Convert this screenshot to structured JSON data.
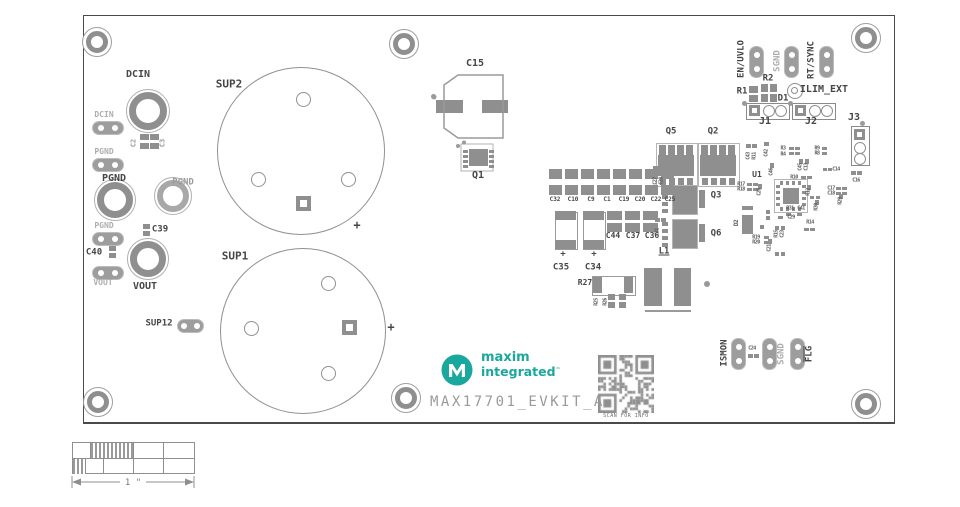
{
  "board": {
    "title": "MAX17701_EVKIT_A",
    "qr_caption": "SCAN FOR INFO",
    "scale_label": "1 \"",
    "brand": {
      "line1": "maxim",
      "line2": "integrated",
      "tm": "™"
    }
  },
  "colors": {
    "teal": "#1aa79e",
    "silk_gray": "#8f8f8f",
    "label_dark": "#464646",
    "label_light": "#aeaeae"
  },
  "labels": [
    {
      "id": "dcin-terminal",
      "text": "DCIN",
      "x": 138,
      "y": 75
    },
    {
      "id": "pgnd-terminal",
      "text": "PGND",
      "x": 114,
      "y": 179
    },
    {
      "id": "pgnd-terminal-2",
      "text": "PGND",
      "x": 183,
      "y": 183,
      "cls": "med",
      "size": 9
    },
    {
      "id": "vout-terminal",
      "text": "VOUT",
      "x": 145,
      "y": 287
    },
    {
      "id": "sup2",
      "text": "SUP2",
      "x": 229,
      "y": 84,
      "size": 11
    },
    {
      "id": "sup1",
      "text": "SUP1",
      "x": 235,
      "y": 256,
      "size": 11
    },
    {
      "id": "sup12",
      "text": "SUP12",
      "x": 159,
      "y": 324,
      "size": 9
    },
    {
      "id": "dcin-tp",
      "text": "DCIN",
      "x": 104,
      "y": 115,
      "cls": "light",
      "size": 8
    },
    {
      "id": "pgnd-tp1",
      "text": "PGND",
      "x": 104,
      "y": 152,
      "cls": "light",
      "size": 8
    },
    {
      "id": "pgnd-tp2",
      "text": "PGND",
      "x": 104,
      "y": 226,
      "cls": "light",
      "size": 8
    },
    {
      "id": "vout-tp",
      "text": "VOUT",
      "x": 103,
      "y": 283,
      "cls": "light",
      "size": 8
    },
    {
      "id": "c2",
      "text": "C2",
      "x": 134,
      "y": 143,
      "rot": -90,
      "cls": "med",
      "size": 7
    },
    {
      "id": "c3",
      "text": "C3",
      "x": 163,
      "y": 143,
      "rot": -90,
      "cls": "med",
      "size": 7
    },
    {
      "id": "c39",
      "text": "C39",
      "x": 160,
      "y": 230,
      "size": 9
    },
    {
      "id": "c40",
      "text": "C40",
      "x": 94,
      "y": 253,
      "size": 9
    },
    {
      "id": "c15",
      "text": "C15",
      "x": 475,
      "y": 64
    },
    {
      "id": "q1",
      "text": "Q1",
      "x": 478,
      "y": 176
    },
    {
      "id": "sup2-plus",
      "text": "+",
      "x": 357,
      "y": 225,
      "size": 12
    },
    {
      "id": "sup1-plus",
      "text": "+",
      "x": 391,
      "y": 327,
      "size": 12
    },
    {
      "id": "c32",
      "text": "C32",
      "x": 555,
      "y": 200,
      "size": 6
    },
    {
      "id": "c10",
      "text": "C10",
      "x": 573,
      "y": 200,
      "size": 6
    },
    {
      "id": "c9",
      "text": "C9",
      "x": 591,
      "y": 200,
      "size": 6
    },
    {
      "id": "c1",
      "text": "C1",
      "x": 607,
      "y": 200,
      "size": 6
    },
    {
      "id": "c19",
      "text": "C19",
      "x": 624,
      "y": 200,
      "size": 6
    },
    {
      "id": "c20",
      "text": "C20",
      "x": 640,
      "y": 200,
      "size": 6
    },
    {
      "id": "c22",
      "text": "C22",
      "x": 656,
      "y": 200,
      "size": 6
    },
    {
      "id": "c25",
      "text": "C25",
      "x": 670,
      "y": 200,
      "size": 6
    },
    {
      "id": "c44",
      "text": "C44",
      "x": 613,
      "y": 236,
      "size": 8
    },
    {
      "id": "c37",
      "text": "C37",
      "x": 633,
      "y": 236,
      "size": 8
    },
    {
      "id": "c36",
      "text": "C36",
      "x": 652,
      "y": 236,
      "size": 8
    },
    {
      "id": "c35",
      "text": "C35",
      "x": 561,
      "y": 268,
      "size": 9
    },
    {
      "id": "c34",
      "text": "C34",
      "x": 593,
      "y": 268,
      "size": 9
    },
    {
      "id": "c35-plus",
      "text": "+",
      "x": 563,
      "y": 255,
      "size": 9
    },
    {
      "id": "c34-plus",
      "text": "+",
      "x": 594,
      "y": 255,
      "size": 9
    },
    {
      "id": "r27",
      "text": "R27",
      "x": 585,
      "y": 283,
      "size": 8
    },
    {
      "id": "r25",
      "text": "R25",
      "x": 597,
      "y": 302,
      "rot": -90,
      "cls": "tiny"
    },
    {
      "id": "r26",
      "text": "R26",
      "x": 606,
      "y": 302,
      "rot": -90,
      "cls": "tiny"
    },
    {
      "id": "l1",
      "text": "L1",
      "x": 664,
      "y": 252,
      "size": 9,
      "cls": "underline"
    },
    {
      "id": "q5",
      "text": "Q5",
      "x": 671,
      "y": 132,
      "size": 9
    },
    {
      "id": "q2",
      "text": "Q2",
      "x": 713,
      "y": 132,
      "size": 9
    },
    {
      "id": "q3",
      "text": "Q3",
      "x": 716,
      "y": 196,
      "size": 9
    },
    {
      "id": "q6",
      "text": "Q6",
      "x": 716,
      "y": 234,
      "size": 9
    },
    {
      "id": "c27",
      "text": "C27",
      "x": 656,
      "y": 181,
      "rot": -90,
      "cls": "tiny"
    },
    {
      "id": "c28",
      "text": "C28",
      "x": 662,
      "y": 181,
      "rot": -90,
      "cls": "tiny"
    },
    {
      "id": "c31",
      "text": "C31",
      "x": 658,
      "y": 232,
      "rot": -90,
      "cls": "tiny"
    },
    {
      "id": "en-uvlo",
      "text": "EN/UVLO",
      "x": 742,
      "y": 59,
      "rot": -90,
      "size": 9
    },
    {
      "id": "sgnd-top",
      "text": "SGND",
      "x": 778,
      "y": 61,
      "rot": -90,
      "cls": "light",
      "size": 9
    },
    {
      "id": "rt-sync",
      "text": "RT/SYNC",
      "x": 812,
      "y": 60,
      "rot": -90,
      "size": 9
    },
    {
      "id": "r2",
      "text": "R2",
      "x": 768,
      "y": 79,
      "size": 9
    },
    {
      "id": "r1",
      "text": "R1",
      "x": 742,
      "y": 92,
      "size": 9
    },
    {
      "id": "d1",
      "text": "D1",
      "x": 783,
      "y": 99,
      "size": 9
    },
    {
      "id": "ilim-ext",
      "text": "ILIM_EXT",
      "x": 824,
      "y": 90
    },
    {
      "id": "j1",
      "text": "J1",
      "x": 765,
      "y": 122
    },
    {
      "id": "j2",
      "text": "J2",
      "x": 811,
      "y": 122
    },
    {
      "id": "j3",
      "text": "J3",
      "x": 854,
      "y": 118
    },
    {
      "id": "ismon",
      "text": "ISMON",
      "x": 725,
      "y": 353,
      "rot": -90,
      "size": 9
    },
    {
      "id": "c24",
      "text": "C24",
      "x": 752,
      "y": 349,
      "cls": "tiny"
    },
    {
      "id": "sgnd-bottom",
      "text": "SGND",
      "x": 782,
      "y": 354,
      "rot": -90,
      "cls": "light",
      "size": 9
    },
    {
      "id": "flg",
      "text": "FLG",
      "x": 810,
      "y": 354,
      "rot": -90,
      "size": 9,
      "cls": "overline"
    },
    {
      "id": "u1",
      "text": "U1",
      "x": 757,
      "y": 175,
      "size": 8
    },
    {
      "id": "c43",
      "text": "C43",
      "x": 749,
      "y": 156,
      "rot": -90,
      "cls": "tiny"
    },
    {
      "id": "r11",
      "text": "R11",
      "x": 755,
      "y": 156,
      "rot": -90,
      "cls": "tiny"
    },
    {
      "id": "c42",
      "text": "C42",
      "x": 767,
      "y": 153,
      "rot": -90,
      "cls": "tiny"
    },
    {
      "id": "r3",
      "text": "R3",
      "x": 783,
      "y": 149,
      "cls": "tiny"
    },
    {
      "id": "r4",
      "text": "R4",
      "x": 783,
      "y": 155,
      "cls": "tiny"
    },
    {
      "id": "r9",
      "text": "R9",
      "x": 817,
      "y": 149,
      "cls": "tiny"
    },
    {
      "id": "r8",
      "text": "R8",
      "x": 817,
      "y": 154,
      "cls": "tiny"
    },
    {
      "id": "c46",
      "text": "C46",
      "x": 772,
      "y": 172,
      "rot": -90,
      "cls": "tiny"
    },
    {
      "id": "c45",
      "text": "C45",
      "x": 801,
      "y": 167,
      "rot": -90,
      "cls": "tiny"
    },
    {
      "id": "c13",
      "text": "C13",
      "x": 807,
      "y": 167,
      "rot": -90,
      "cls": "tiny"
    },
    {
      "id": "c14",
      "text": "C14",
      "x": 836,
      "y": 170,
      "cls": "tiny"
    },
    {
      "id": "r10",
      "text": "R10",
      "x": 794,
      "y": 178,
      "cls": "tiny"
    },
    {
      "id": "r17",
      "text": "R17",
      "x": 741,
      "y": 185,
      "cls": "tiny"
    },
    {
      "id": "r18",
      "text": "R18",
      "x": 741,
      "y": 190,
      "cls": "tiny"
    },
    {
      "id": "c26",
      "text": "C26",
      "x": 760,
      "y": 192,
      "rot": -90,
      "cls": "tiny"
    },
    {
      "id": "d2",
      "text": "D2",
      "x": 737,
      "y": 223,
      "rot": -90,
      "cls": "tiny",
      "size": 6
    },
    {
      "id": "r12",
      "text": "R12",
      "x": 809,
      "y": 192,
      "rot": -90,
      "cls": "tiny"
    },
    {
      "id": "c17",
      "text": "C17",
      "x": 831,
      "y": 189,
      "cls": "tiny"
    },
    {
      "id": "c18",
      "text": "C18",
      "x": 831,
      "y": 194,
      "cls": "tiny"
    },
    {
      "id": "r29",
      "text": "R29",
      "x": 841,
      "y": 201,
      "rot": -90,
      "cls": "tiny"
    },
    {
      "id": "r31",
      "text": "R31",
      "x": 790,
      "y": 209,
      "cls": "tiny"
    },
    {
      "id": "c41",
      "text": "C41",
      "x": 801,
      "y": 209,
      "cls": "tiny"
    },
    {
      "id": "r30",
      "text": "R30",
      "x": 817,
      "y": 207,
      "rot": -90,
      "cls": "tiny"
    },
    {
      "id": "r19",
      "text": "R19",
      "x": 756,
      "y": 238,
      "cls": "tiny"
    },
    {
      "id": "r20",
      "text": "R20",
      "x": 756,
      "y": 243,
      "cls": "tiny"
    },
    {
      "id": "c21",
      "text": "C21",
      "x": 770,
      "y": 248,
      "rot": -90,
      "cls": "tiny"
    },
    {
      "id": "c29",
      "text": "C29",
      "x": 791,
      "y": 218,
      "cls": "tiny"
    },
    {
      "id": "r14",
      "text": "R14",
      "x": 810,
      "y": 223,
      "cls": "tiny"
    },
    {
      "id": "r15",
      "text": "R15",
      "x": 777,
      "y": 234,
      "rot": -90,
      "cls": "tiny"
    },
    {
      "id": "c23",
      "text": "C23",
      "x": 783,
      "y": 234,
      "rot": -90,
      "cls": "tiny"
    },
    {
      "id": "c16",
      "text": "C16",
      "x": 856,
      "y": 181,
      "cls": "tiny"
    }
  ],
  "pads": [
    [
      549,
      169,
      13,
      10
    ],
    [
      565,
      169,
      13,
      10
    ],
    [
      581,
      169,
      13,
      10
    ],
    [
      597,
      169,
      13,
      10
    ],
    [
      613,
      169,
      13,
      10
    ],
    [
      629,
      169,
      13,
      10
    ],
    [
      645,
      169,
      13,
      10
    ],
    [
      661,
      169,
      13,
      10
    ],
    [
      549,
      185,
      13,
      10
    ],
    [
      565,
      185,
      13,
      10
    ],
    [
      581,
      185,
      13,
      10
    ],
    [
      597,
      185,
      13,
      10
    ],
    [
      613,
      185,
      13,
      10
    ],
    [
      629,
      185,
      13,
      10
    ],
    [
      645,
      185,
      13,
      10
    ],
    [
      661,
      185,
      13,
      10
    ],
    [
      607,
      211,
      15,
      9
    ],
    [
      625,
      211,
      15,
      9
    ],
    [
      643,
      211,
      15,
      9
    ],
    [
      607,
      223,
      15,
      9
    ],
    [
      625,
      223,
      15,
      9
    ],
    [
      643,
      223,
      15,
      9
    ],
    [
      555,
      211,
      21,
      9
    ],
    [
      555,
      240,
      21,
      9
    ],
    [
      583,
      211,
      21,
      9
    ],
    [
      583,
      240,
      21,
      9
    ],
    [
      140,
      134,
      9,
      6
    ],
    [
      140,
      143,
      9,
      6
    ],
    [
      150,
      134,
      9,
      6
    ],
    [
      150,
      143,
      9,
      6
    ],
    [
      143,
      224,
      7,
      5
    ],
    [
      143,
      231,
      7,
      5
    ],
    [
      109,
      246,
      7,
      5
    ],
    [
      109,
      253,
      7,
      5
    ],
    [
      608,
      294,
      7,
      6
    ],
    [
      608,
      302,
      7,
      6
    ],
    [
      619,
      294,
      7,
      6
    ],
    [
      619,
      302,
      7,
      6
    ],
    [
      593,
      277,
      9,
      16
    ],
    [
      624,
      277,
      9,
      16
    ],
    [
      644,
      268,
      18,
      38
    ],
    [
      674,
      268,
      17,
      38
    ],
    [
      653,
      166,
      5,
      4
    ],
    [
      660,
      166,
      5,
      4
    ],
    [
      655,
      218,
      5,
      4
    ],
    [
      661,
      218,
      5,
      4
    ],
    [
      749,
      86,
      9,
      7
    ],
    [
      749,
      95,
      9,
      7
    ],
    [
      761,
      84,
      7,
      8
    ],
    [
      770,
      84,
      7,
      8
    ],
    [
      761,
      94,
      7,
      8
    ],
    [
      770,
      94,
      7,
      8
    ],
    [
      851,
      171,
      5,
      4
    ],
    [
      857,
      171,
      5,
      4
    ],
    [
      748,
      354,
      5,
      4
    ],
    [
      754,
      354,
      5,
      4
    ],
    [
      746,
      144,
      5,
      4
    ],
    [
      752,
      144,
      5,
      4
    ],
    [
      764,
      142,
      5,
      4
    ],
    [
      789,
      147,
      5,
      3
    ],
    [
      795,
      147,
      5,
      3
    ],
    [
      789,
      152,
      5,
      3
    ],
    [
      795,
      152,
      5,
      3
    ],
    [
      822,
      147,
      5,
      3
    ],
    [
      822,
      152,
      5,
      3
    ],
    [
      770,
      163,
      4,
      5
    ],
    [
      799,
      159,
      4,
      5
    ],
    [
      805,
      159,
      4,
      5
    ],
    [
      823,
      168,
      4,
      3
    ],
    [
      828,
      168,
      4,
      3
    ],
    [
      801,
      176,
      5,
      3
    ],
    [
      807,
      176,
      5,
      3
    ],
    [
      747,
      183,
      5,
      3
    ],
    [
      753,
      183,
      5,
      3
    ],
    [
      747,
      188,
      5,
      3
    ],
    [
      753,
      188,
      5,
      3
    ],
    [
      758,
      184,
      4,
      5
    ],
    [
      807,
      185,
      4,
      5
    ],
    [
      836,
      187,
      5,
      3
    ],
    [
      842,
      187,
      5,
      3
    ],
    [
      836,
      192,
      5,
      3
    ],
    [
      842,
      192,
      5,
      3
    ],
    [
      839,
      194,
      4,
      5
    ],
    [
      786,
      213,
      5,
      3
    ],
    [
      797,
      213,
      5,
      3
    ],
    [
      815,
      200,
      4,
      5
    ],
    [
      764,
      236,
      5,
      3
    ],
    [
      764,
      241,
      5,
      3
    ],
    [
      768,
      239,
      4,
      5
    ],
    [
      778,
      216,
      5,
      3
    ],
    [
      804,
      228,
      5,
      3
    ],
    [
      810,
      228,
      5,
      3
    ],
    [
      775,
      226,
      4,
      4
    ],
    [
      781,
      226,
      4,
      4
    ],
    [
      810,
      196,
      4,
      3
    ],
    [
      816,
      196,
      4,
      3
    ],
    [
      766,
      210,
      4,
      4
    ],
    [
      766,
      216,
      4,
      4
    ],
    [
      775,
      252,
      4,
      4
    ],
    [
      781,
      252,
      4,
      4
    ],
    [
      760,
      225,
      4,
      4
    ],
    [
      436,
      100,
      27,
      13
    ],
    [
      482,
      100,
      26,
      13
    ]
  ]
}
